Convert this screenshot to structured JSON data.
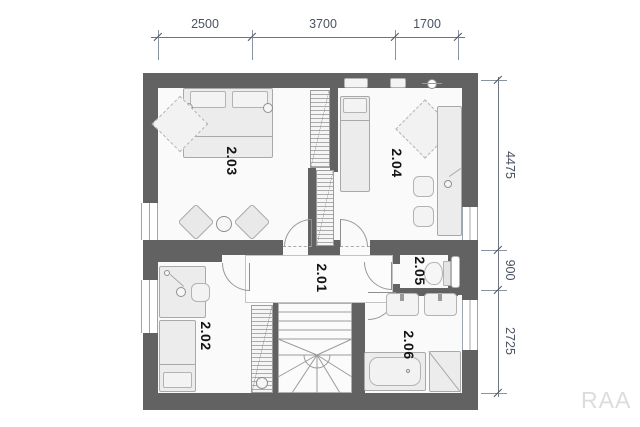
{
  "rooms": [
    {
      "id": "2.01"
    },
    {
      "id": "2.02"
    },
    {
      "id": "2.03"
    },
    {
      "id": "2.04"
    },
    {
      "id": "2.05"
    },
    {
      "id": "2.06"
    }
  ],
  "dimensions": {
    "top": [
      "2500",
      "3700",
      "1700"
    ],
    "right": [
      "4475",
      "900",
      "2725"
    ]
  },
  "watermark": "RAA",
  "colors": {
    "wall": "#626262",
    "floor": "#fafafa",
    "dimension_text": "#4a5362",
    "room_label": "#141414",
    "furniture_fill": "#ececec",
    "furniture_stroke": "#a9a9a9",
    "watermark": "#dcdcdc"
  }
}
